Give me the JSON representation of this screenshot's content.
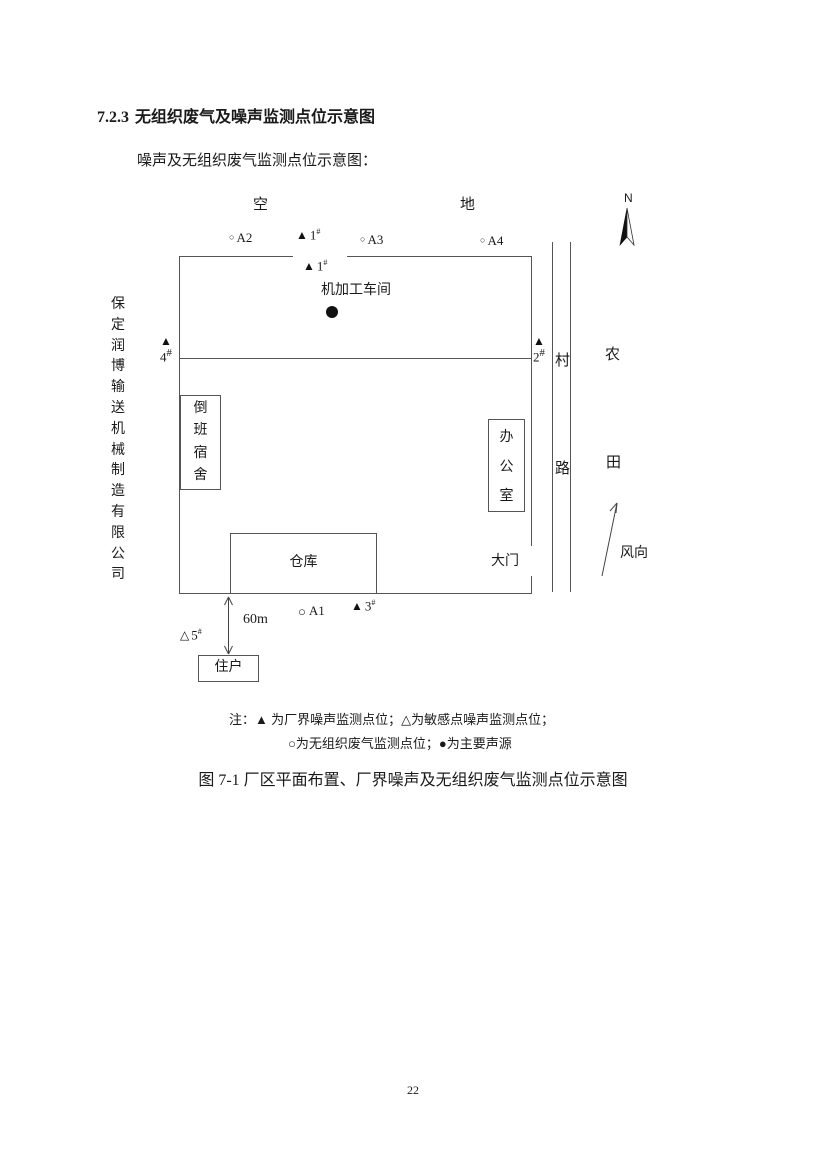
{
  "heading": {
    "number": "7.2.3",
    "title": "无组织废气及噪声监测点位示意图"
  },
  "intro": "噪声及无组织废气监测点位示意图：",
  "diagram": {
    "surroundings": {
      "top_left": "空",
      "top_right": "地",
      "road_char_top": "村",
      "road_char_bottom": "路",
      "farm_char_top": "农",
      "farm_char_bottom": "田"
    },
    "company_name": "保定润博输送机械制造有限公司",
    "north_label": "N",
    "wind_label": "风向",
    "distance_label": "60m",
    "buildings": {
      "workshop": "机加工车间",
      "dorm": "倒班宿舍",
      "office": "办公室",
      "warehouse": "仓库",
      "gate": "大门",
      "resident": "住户"
    },
    "markers": {
      "a1": {
        "symbol": "○",
        "label": "A1"
      },
      "a2": {
        "symbol": "○",
        "label": "A2"
      },
      "a3": {
        "symbol": "○",
        "label": "A3"
      },
      "a4": {
        "symbol": "○",
        "label": "A4"
      },
      "n1_outer": {
        "symbol": "▲",
        "num": "1",
        "sup": "#"
      },
      "n1_inner": {
        "symbol": "▲",
        "num": "1",
        "sup": "#"
      },
      "n2": {
        "symbol": "▲",
        "num": "2",
        "sup": "#"
      },
      "n3": {
        "symbol": "▲",
        "num": "3",
        "sup": "#"
      },
      "n4": {
        "symbol": "▲",
        "num": "4",
        "sup": "#"
      },
      "n5": {
        "symbol": "△",
        "num": "5",
        "sup": "#"
      }
    }
  },
  "note": {
    "line1": "注：▲ 为厂界噪声监测点位；△为敏感点噪声监测点位；",
    "line2": "○为无组织废气监测点位；●为主要声源"
  },
  "caption": "图 7-1 厂区平面布置、厂界噪声及无组织废气监测点位示意图",
  "page_number": "22"
}
